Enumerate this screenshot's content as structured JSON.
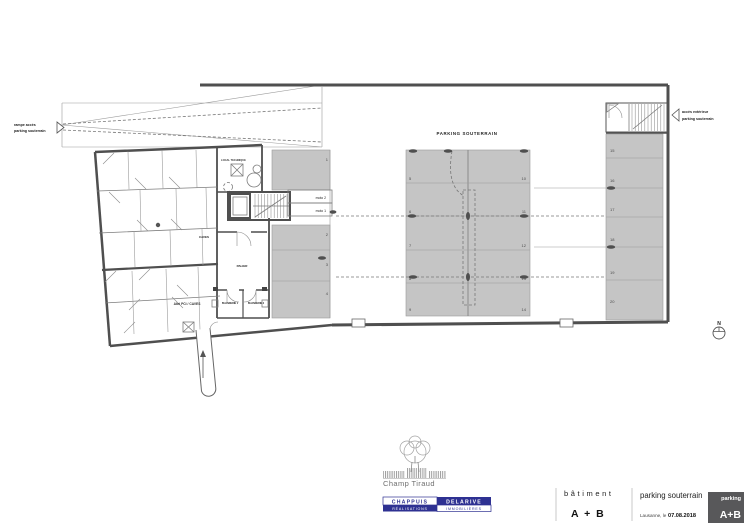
{
  "plan": {
    "title": "PARKING SOUTERRAIN",
    "stall_numbers": [
      "1",
      "2",
      "3",
      "4",
      "5",
      "6",
      "7",
      "8",
      "9",
      "10",
      "11",
      "12",
      "13",
      "14",
      "15",
      "16",
      "17",
      "18",
      "19",
      "20"
    ],
    "moto_stalls": [
      "moto 2",
      "moto 1"
    ],
    "rooms": {
      "local_technique": "LOCAL TECHNIQUE",
      "caves": "CAVES",
      "palier": "PALIER",
      "abri_pci": "Abri PCi / CAVES",
      "buanderie_1": "BUANDERIE 1",
      "buanderie_2": "BUANDERIE 2"
    },
    "annotations": {
      "ramp_access_line1": "rampe accès",
      "ramp_access_line2": "parking souterrain",
      "exterior_access_line1": "accès extérieur",
      "exterior_access_line2": "parking souterrain",
      "north": "N"
    }
  },
  "title_block": {
    "project_logo": "Champ Tiraud",
    "company": {
      "name_left": "CHAPPUIS",
      "name_right": "DELARIVE",
      "sub_left": "RÉALISATIONS",
      "sub_right": "IMMOBILIÈRES"
    },
    "building": {
      "label": "bâtiment",
      "value": "A + B"
    },
    "drawing": {
      "title": "parking souterrain",
      "place_date_label": "Lausanne, le",
      "date": "07.08.2018"
    },
    "badge": {
      "top": "parking",
      "main": "A+B"
    }
  },
  "colors": {
    "wall": "#4f4f4f",
    "stall_fill": "#c5c5c5",
    "brand_navy": "#2e3192",
    "badge_gray": "#58585a"
  }
}
